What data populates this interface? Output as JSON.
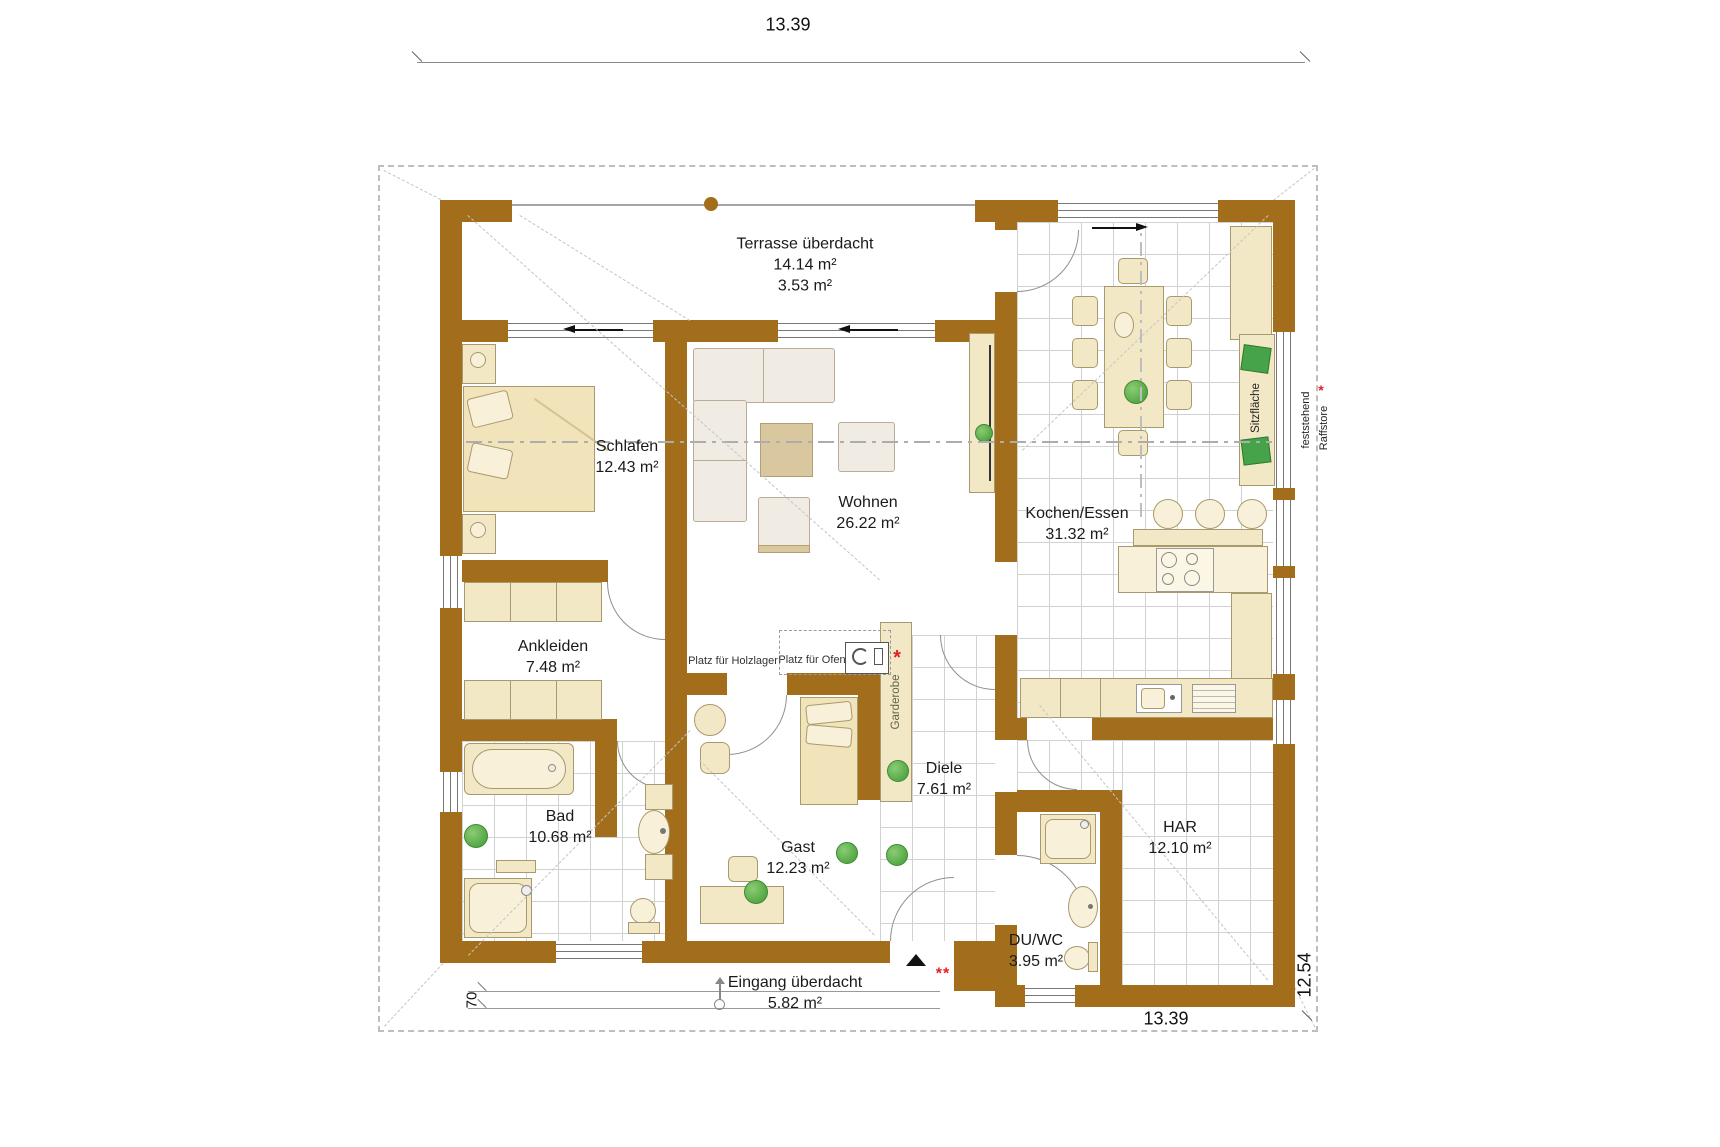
{
  "dimensions": {
    "top_width": "13.39",
    "bottom_width": "13.39",
    "right_height": "12.54",
    "entrance_depth": "70"
  },
  "rooms": [
    {
      "name": "Terrasse überdacht",
      "area": "14.14 m²",
      "area2": "3.53 m²"
    },
    {
      "name": "Schlafen",
      "area": "12.43 m²"
    },
    {
      "name": "Wohnen",
      "area": "26.22 m²"
    },
    {
      "name": "Kochen/Essen",
      "area": "31.32 m²"
    },
    {
      "name": "Ankleiden",
      "area": "7.48 m²"
    },
    {
      "name": "Bad",
      "area": "10.68 m²"
    },
    {
      "name": "Gast",
      "area": "12.23 m²"
    },
    {
      "name": "Diele",
      "area": "7.61 m²"
    },
    {
      "name": "HAR",
      "area": "12.10 m²"
    },
    {
      "name": "DU/WC",
      "area": "3.95 m²"
    },
    {
      "name": "Eingang überdacht",
      "area": "5.82 m²"
    }
  ],
  "annotations": {
    "holzlager": "Platz für Holzlager",
    "ofen": "Platz für Ofen",
    "garderobe": "Garderobe",
    "sitzflaeche": "Sitzfläche",
    "feststehend": "feststehend",
    "raffstore": "Raffstore",
    "asterisk": "*",
    "double_asterisk": "**"
  },
  "colors": {
    "wall": "#A26E1C",
    "furniture": "#F3E8C6",
    "furniture_light": "#F8F0D8",
    "tile_line": "#D2D2D2",
    "green": "#55A845",
    "red": "#E31E24"
  }
}
